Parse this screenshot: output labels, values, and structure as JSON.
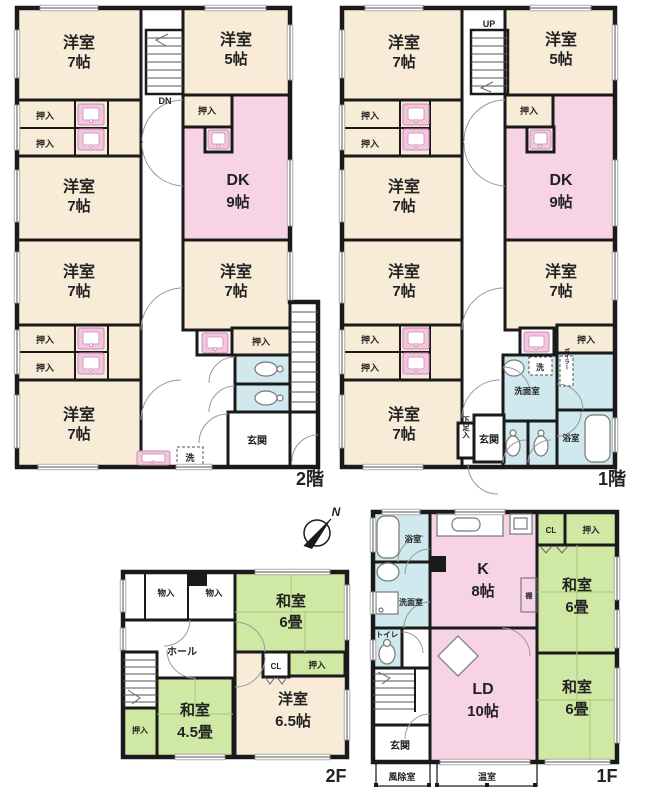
{
  "colors": {
    "wall": "#1a1a1a",
    "western_room": "#f8ecd9",
    "dining_living": "#f7d4e5",
    "japanese_room": "#cfe9a4",
    "wet_area": "#cfe9ee",
    "fixture_pink": "#f3c6dc"
  },
  "shared": {
    "oshiire": "押入",
    "monoire": "物入",
    "cl": "CL",
    "sen": "洗",
    "genkan": "玄関",
    "shitasokuire": "下足入",
    "senmenshitsu": "洗面室",
    "yokushitsu": "浴室",
    "toire": "トイレ",
    "boiler": "ボイラー",
    "tana": "棚",
    "hall": "ホール",
    "fujoshitsu": "風除室",
    "onshitsu": "温室",
    "dn": "DN",
    "up": "UP",
    "north": "N"
  },
  "plans": {
    "a": {
      "label": "2階",
      "rooms": [
        {
          "name": "洋室",
          "size": "7帖"
        },
        {
          "name": "洋室",
          "size": "5帖"
        },
        {
          "name": "洋室",
          "size": "7帖"
        },
        {
          "name": "DK",
          "size": "9帖"
        },
        {
          "name": "洋室",
          "size": "7帖"
        },
        {
          "name": "洋室",
          "size": "7帖"
        },
        {
          "name": "洋室",
          "size": "7帖"
        }
      ]
    },
    "b": {
      "label": "1階",
      "rooms": [
        {
          "name": "洋室",
          "size": "7帖"
        },
        {
          "name": "洋室",
          "size": "5帖"
        },
        {
          "name": "洋室",
          "size": "7帖"
        },
        {
          "name": "DK",
          "size": "9帖"
        },
        {
          "name": "洋室",
          "size": "7帖"
        },
        {
          "name": "洋室",
          "size": "7帖"
        },
        {
          "name": "洋室",
          "size": "7帖"
        }
      ]
    },
    "c": {
      "label": "2F",
      "rooms": [
        {
          "name": "和室",
          "size": "6畳"
        },
        {
          "name": "和室",
          "size": "4.5畳"
        },
        {
          "name": "洋室",
          "size": "6.5帖"
        }
      ]
    },
    "d": {
      "label": "1F",
      "rooms": [
        {
          "name": "K",
          "size": "8帖"
        },
        {
          "name": "LD",
          "size": "10帖"
        },
        {
          "name": "和室",
          "size": "6畳"
        },
        {
          "name": "和室",
          "size": "6畳"
        }
      ]
    }
  }
}
